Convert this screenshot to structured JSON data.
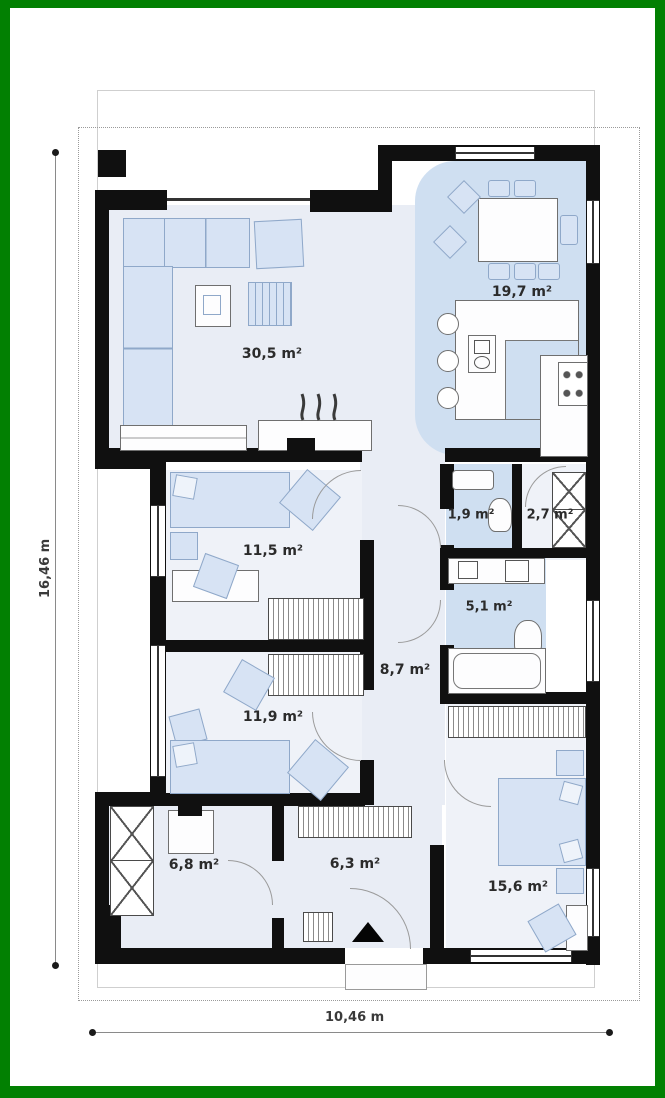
{
  "plan": {
    "type": "single-storey house floor plan",
    "rooms": {
      "living": {
        "area": "30,5 m²"
      },
      "dining_kitchen": {
        "area": "19,7 m²"
      },
      "bedroom1": {
        "area": "11,5 m²"
      },
      "bedroom2": {
        "area": "11,9 m²"
      },
      "hallway": {
        "area": "8,7 m²"
      },
      "wc": {
        "area": "1,9 m²"
      },
      "pantry": {
        "area": "2,7 m²"
      },
      "bathroom": {
        "area": "5,1 m²"
      },
      "bedroom3": {
        "area": "15,6 m²"
      },
      "utility": {
        "area": "6,8 m²"
      },
      "entry_hall": {
        "area": "6,3 m²"
      }
    },
    "dimensions": {
      "total_height": "16,46 m",
      "total_width": "10,46 m"
    },
    "colors": {
      "frame_green": "#028002",
      "wall_black": "#101010",
      "floor_light": "#e9edf5",
      "floor_blue": "#cfdff1",
      "furniture_blue": "#d7e3f4"
    }
  }
}
